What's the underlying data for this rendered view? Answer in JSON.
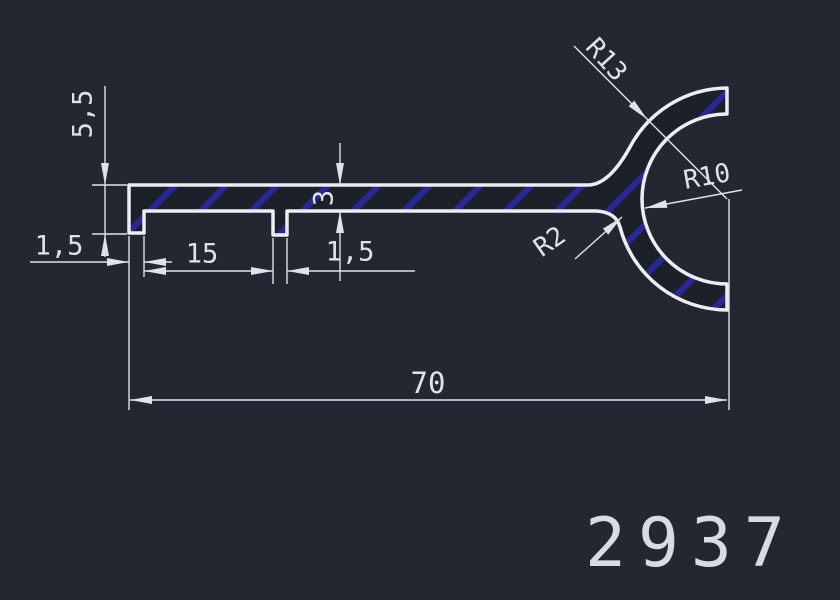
{
  "drawing": {
    "part_number": "2937",
    "dimensions": {
      "flange_height": "5,5",
      "lip_width_left": "1,5",
      "lip_spacing": "15",
      "lip_width_right": "1,5",
      "wall_thickness": "3",
      "overall_length": "70",
      "outer_radius": "R13",
      "inner_radius": "R10",
      "fillet_radius": "R2"
    },
    "colors": {
      "background": "#232731",
      "line": "#edeef2",
      "hatch": "#28289a",
      "dimension": "#dfe2e6",
      "interior": "#1c2029"
    }
  }
}
